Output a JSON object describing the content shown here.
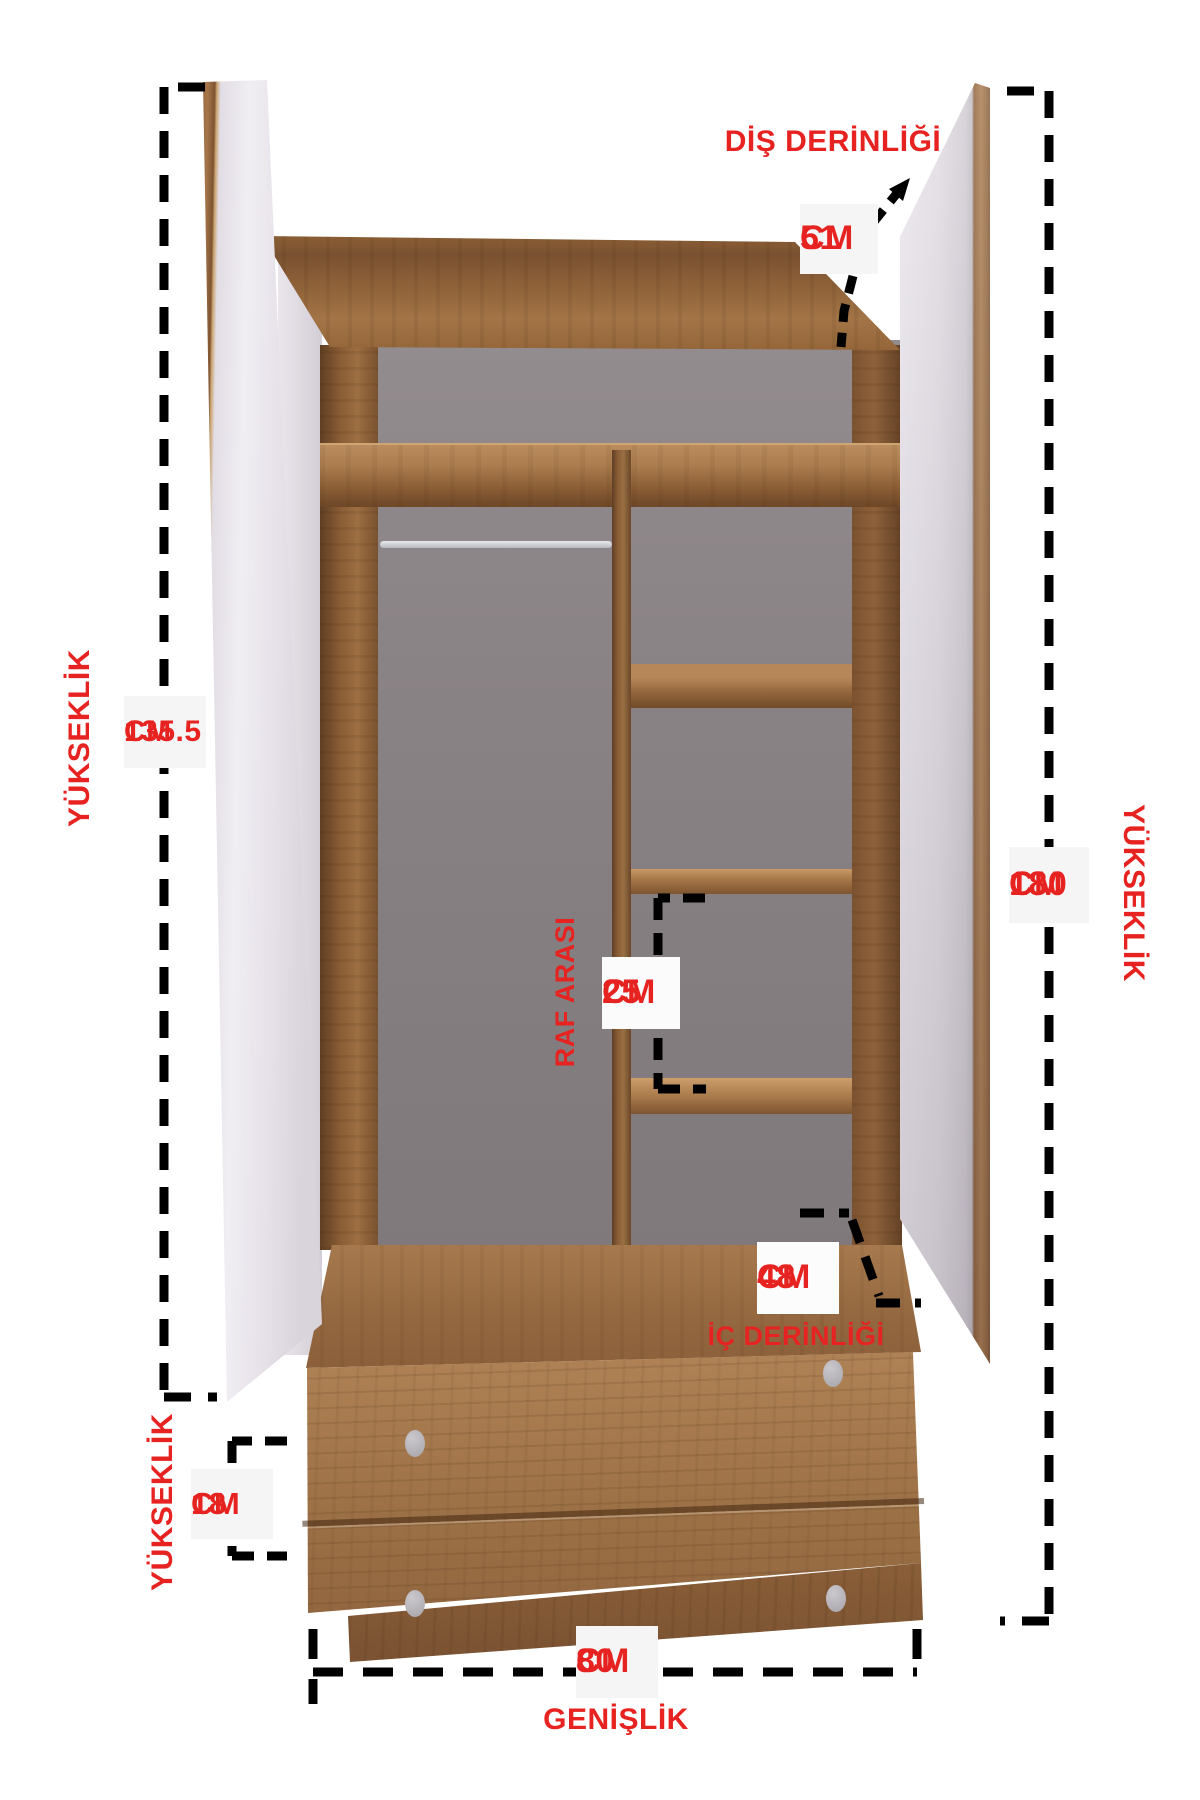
{
  "page": {
    "background": "#ffffff"
  },
  "colors": {
    "accent_red": "#e62320",
    "dash_black": "#000000",
    "label_box_bg": "#f5f5f5",
    "wood_mid": "#a07249",
    "interior_gray": "#8c8587",
    "door_face": "#e9e5ec"
  },
  "dimensions": {
    "outer_depth": {
      "label": "DİŞ DERİNLİĞİ",
      "value": "51",
      "unit": "CM"
    },
    "left_door_height": {
      "label": "YÜKSEKLİK",
      "value": "135.5",
      "unit": "CM"
    },
    "total_height": {
      "label": "YÜKSEKLİK",
      "value": "180",
      "unit": "CM"
    },
    "shelf_spacing": {
      "label": "RAF ARASI",
      "value": "25",
      "unit": "CM"
    },
    "inner_depth": {
      "label": "İÇ DERİNLİĞİ",
      "value": "48",
      "unit": "CM"
    },
    "drawer_height": {
      "label": "YÜKSEKLİK",
      "value": "18",
      "unit": "CM"
    },
    "width": {
      "label": "GENİŞLİK",
      "value": "80",
      "unit": "CM"
    }
  }
}
